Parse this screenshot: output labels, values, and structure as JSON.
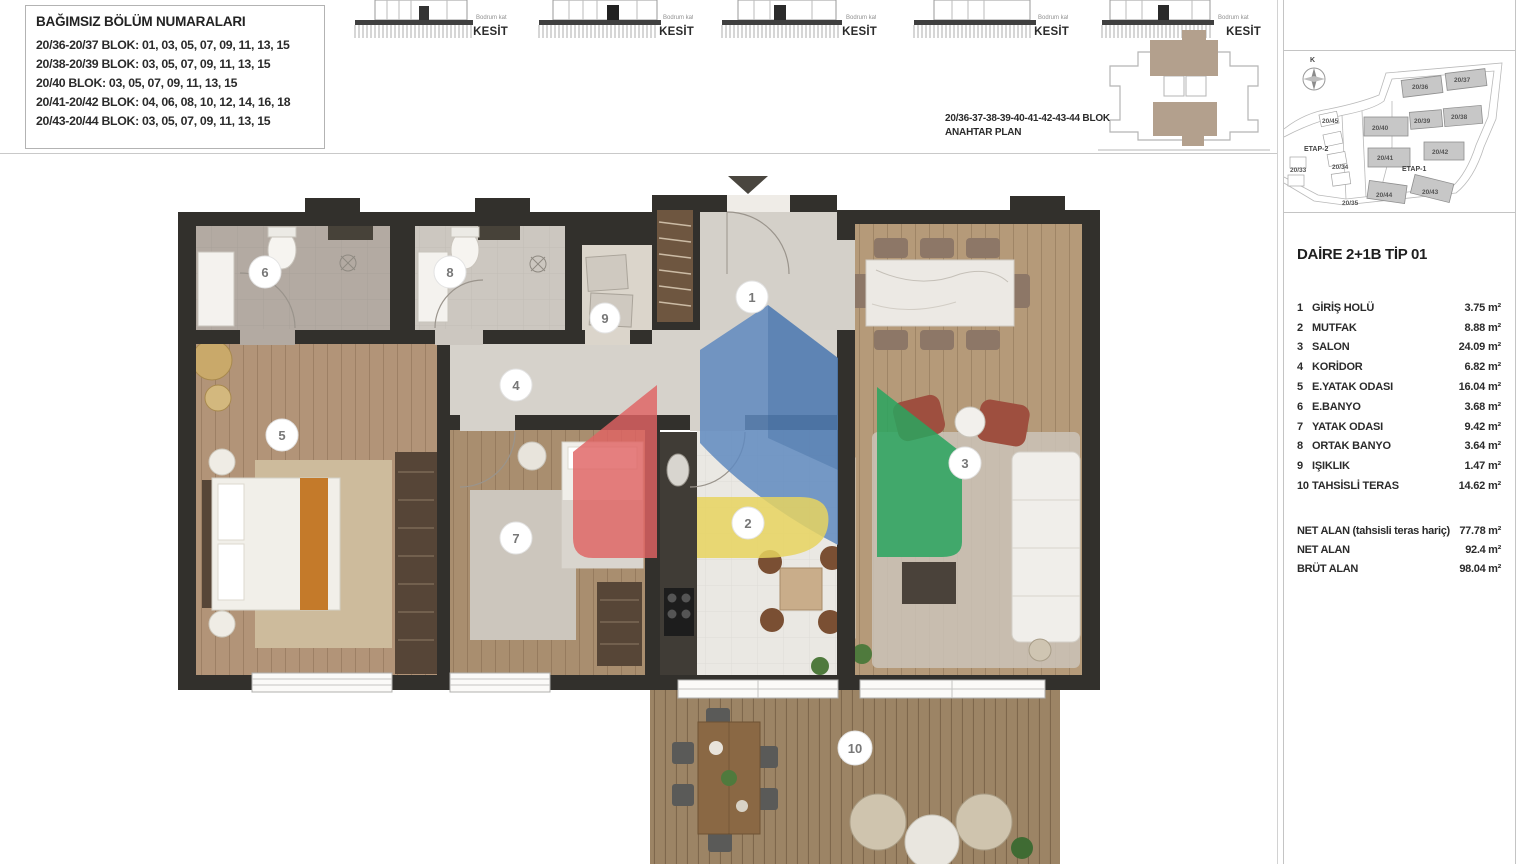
{
  "info_box": {
    "title": "BAĞIMSIZ BÖLÜM NUMARALARI",
    "lines": [
      "20/36-20/37 BLOK: 01, 03, 05, 07, 09, 11, 13, 15",
      "20/38-20/39 BLOK: 03, 05, 07, 09, 11, 13, 15",
      "20/40 BLOK: 03, 05, 07, 09, 11, 13, 15",
      "20/41-20/42 BLOK: 04, 06, 08, 10, 12, 14, 16, 18",
      "20/43-20/44 BLOK: 03, 05, 07, 09, 11, 13, 15"
    ]
  },
  "sections": {
    "label": "KESİT",
    "floor_note": "Bodrum kat"
  },
  "key_plan": {
    "line1": "20/36-37-38-39-40-41-42-43-44 BLOK",
    "line2": "ANAHTAR PLAN"
  },
  "site_plan": {
    "compass": "K",
    "etap1": "ETAP-1",
    "etap2": "ETAP-2",
    "blocks": [
      {
        "label": "20/36"
      },
      {
        "label": "20/37"
      },
      {
        "label": "20/40"
      },
      {
        "label": "20/39"
      },
      {
        "label": "20/38"
      },
      {
        "label": "20/41"
      },
      {
        "label": "20/42"
      },
      {
        "label": "20/44"
      },
      {
        "label": "20/43"
      },
      {
        "label": "20/45"
      },
      {
        "label": "20/33"
      },
      {
        "label": "20/34"
      },
      {
        "label": "20/35"
      }
    ]
  },
  "apartment": {
    "title": "DAİRE 2+1B TİP 01",
    "rooms": [
      {
        "num": "1",
        "name": "GİRİŞ HOLÜ",
        "area": "3.75 m²"
      },
      {
        "num": "2",
        "name": "MUTFAK",
        "area": "8.88 m²"
      },
      {
        "num": "3",
        "name": "SALON",
        "area": "24.09 m²"
      },
      {
        "num": "4",
        "name": "KORİDOR",
        "area": "6.82 m²"
      },
      {
        "num": "5",
        "name": "E.YATAK ODASI",
        "area": "16.04 m²"
      },
      {
        "num": "6",
        "name": "E.BANYO",
        "area": "3.68 m²"
      },
      {
        "num": "7",
        "name": "YATAK ODASI",
        "area": "9.42 m²"
      },
      {
        "num": "8",
        "name": "ORTAK BANYO",
        "area": "3.64 m²"
      },
      {
        "num": "9",
        "name": "IŞIKLIK",
        "area": "1.47 m²"
      },
      {
        "num": "10",
        "name": "TAHSİSLİ TERAS",
        "area": "14.62 m²"
      }
    ],
    "totals": [
      {
        "name": "NET ALAN (tahsisli teras hariç)",
        "area": "77.78 m²"
      },
      {
        "name": "NET ALAN",
        "area": "92.4 m²"
      },
      {
        "name": "BRÜT ALAN",
        "area": "98.04 m²"
      }
    ]
  },
  "colors": {
    "wall": "#32302c",
    "watermark_blue": "#5f89c0",
    "watermark_red": "#df6363",
    "watermark_yellow": "#e7d45f",
    "watermark_green": "#29a45f",
    "keyplan_highlight": "#b3a08d"
  }
}
